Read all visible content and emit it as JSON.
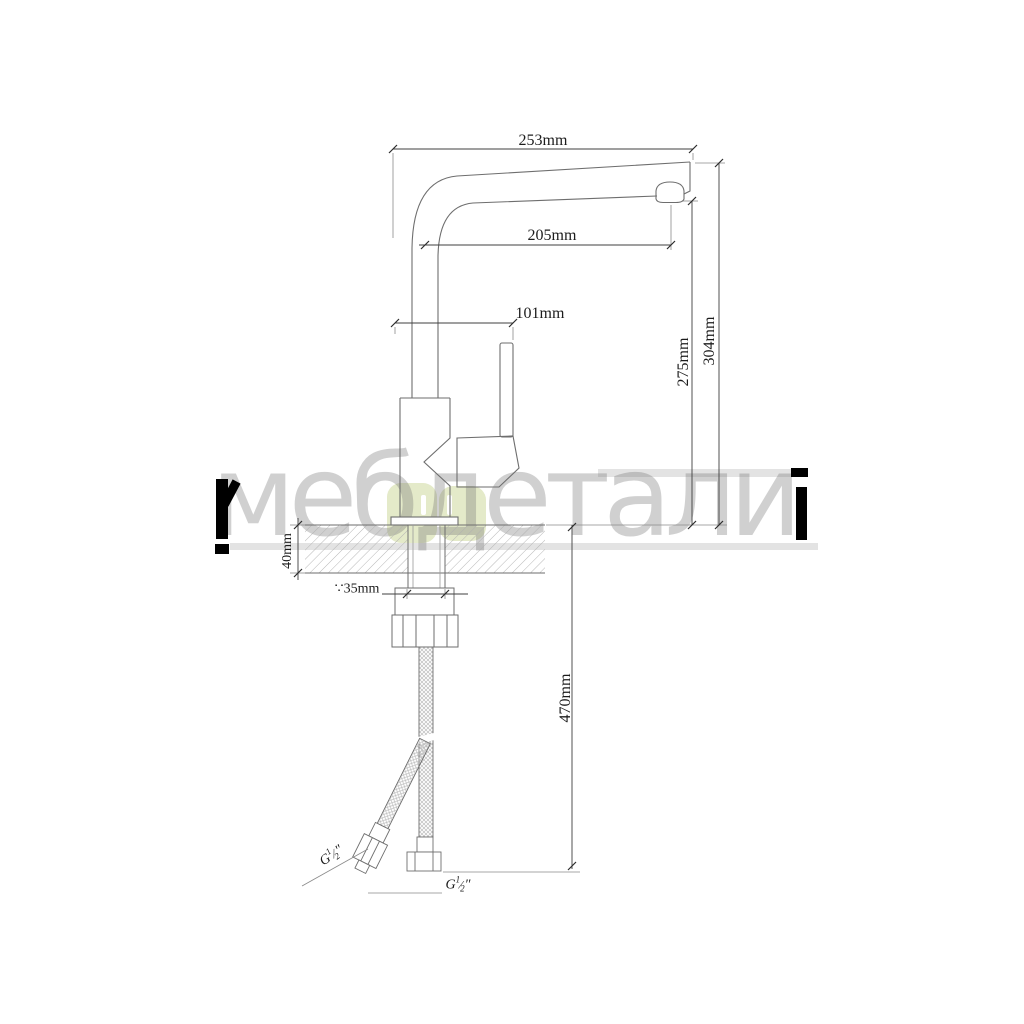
{
  "watermark": {
    "text": "мебдетали",
    "green_hex": "#e4eac9",
    "letter_hex": "#d3d3d3",
    "accent_hex": "#000000"
  },
  "dimensions": {
    "spout_overall_width": "253mm",
    "spout_reach": "205mm",
    "handle_span": "101mm",
    "spout_outlet_height": "275mm",
    "total_height": "304mm",
    "deck_thickness": "40mm",
    "hole_diameter": "∵35mm",
    "hose_drop": "470mm"
  },
  "threads": {
    "left": {
      "prefix": "G",
      "numerator": "1",
      "slash": "⁄",
      "denominator": "2",
      "unit": "″"
    },
    "right": {
      "prefix": "G",
      "numerator": "1",
      "slash": "⁄",
      "denominator": "2",
      "unit": "″"
    }
  },
  "line_colors": {
    "outline": "#6e6e6e",
    "dimension": "#3f3f3f",
    "hatch": "#b0b0b0"
  }
}
